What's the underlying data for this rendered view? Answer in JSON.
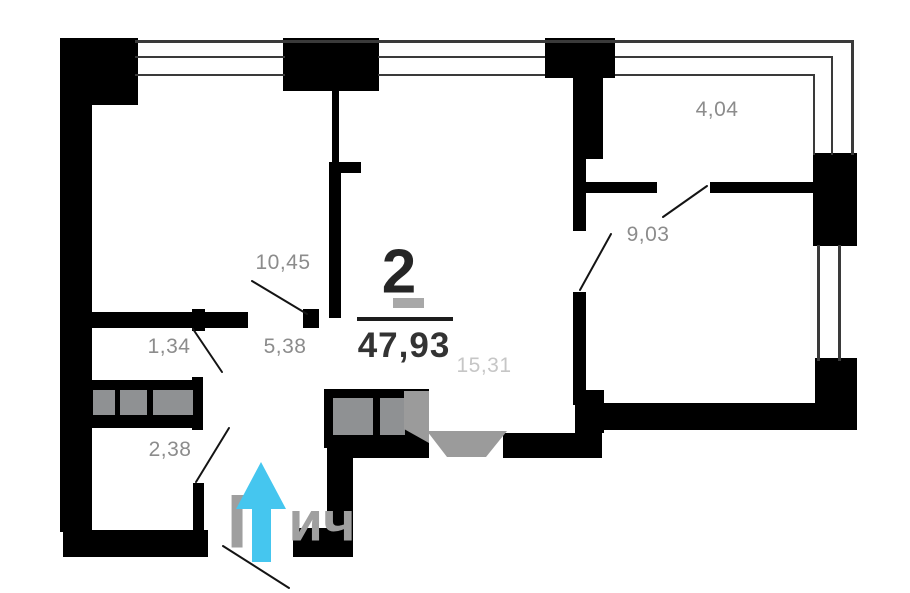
{
  "plan": {
    "rooms_count": "2",
    "total_area": "47,93",
    "rooms": [
      {
        "name": "bedroom-top-left",
        "area": "10,45"
      },
      {
        "name": "closet-small",
        "area": "1,34"
      },
      {
        "name": "hallway",
        "area": "5,38"
      },
      {
        "name": "storage",
        "area": "2,38"
      },
      {
        "name": "living-room",
        "area": "15,31"
      },
      {
        "name": "bedroom-right",
        "area": "9,03"
      },
      {
        "name": "balcony",
        "area": "4,04"
      }
    ]
  },
  "watermark": {
    "left_fragment": "Г",
    "right_fragment": "ич"
  },
  "colors": {
    "wall": "#000000",
    "area_label": "#8c8c8c",
    "area_label_light": "#c6c6c6",
    "entrance_arrow": "#45c6ef",
    "furniture_fill": "#8f9193",
    "door_mark": "#9b9b9b"
  },
  "icons": {
    "entrance": "up-arrow-icon"
  }
}
